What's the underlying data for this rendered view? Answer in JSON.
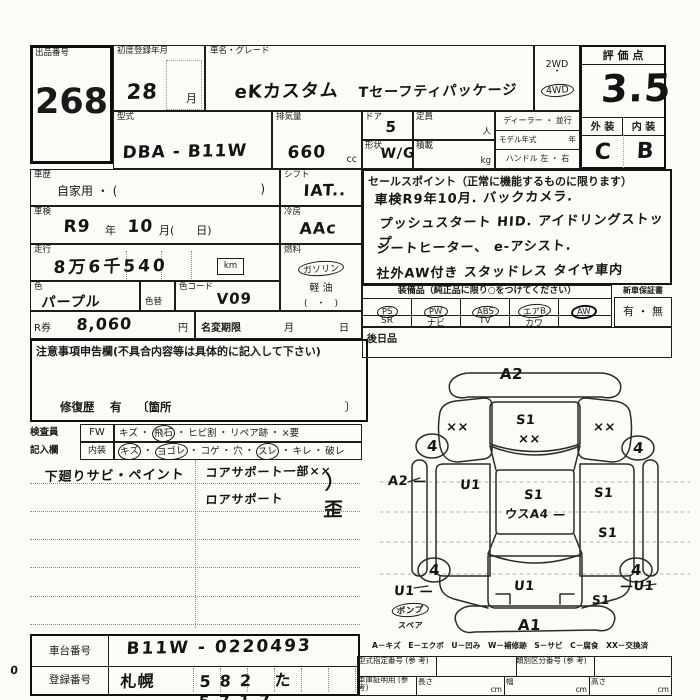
{
  "sheet": {
    "lot": {
      "label": "出品番号",
      "number": "268"
    },
    "first_reg": {
      "label": "初度登録年月",
      "value": "28",
      "unit": "月"
    },
    "car_name": {
      "label": "車名・グレード",
      "name": "eKカスタム",
      "grade": "Tセーフティパッケージ"
    },
    "drive": {
      "opt_2wd": "2WD",
      "dot": "・",
      "opt_4wd": "4WD"
    },
    "score": {
      "label": "評 価 点",
      "value": "3.5",
      "ext_label": "外 装",
      "int_label": "内 装",
      "ext_value": "C",
      "int_value": "B"
    },
    "model": {
      "label": "型式",
      "value": "DBA - B11W"
    },
    "displacement": {
      "label": "排気量",
      "value": "660",
      "unit": "cc"
    },
    "door": {
      "label": "ドア",
      "value": "5"
    },
    "capacity": {
      "label": "定員",
      "unit": "人"
    },
    "shape": {
      "label": "形状",
      "value": "W/G"
    },
    "load": {
      "label": "積載",
      "unit": "kg"
    },
    "dealer": {
      "row1": "ディーラー ・ 並行",
      "row2a": "モデル年式",
      "row2b": "年",
      "row3": "ハンドル 左 ・ 右"
    },
    "history": {
      "label": "車歴",
      "value": "自家用 ・ (",
      "close": ")"
    },
    "shift": {
      "label": "シフト",
      "value": "IAT.."
    },
    "shaken": {
      "label": "車検",
      "era": "R9",
      "year_label": "年",
      "month": "10",
      "rest": "月(　　日)"
    },
    "ac": {
      "label": "冷房",
      "value": "AAc"
    },
    "mileage": {
      "label": "走行",
      "value": "8万6千540",
      "unit": "km"
    },
    "fuel": {
      "label": "燃料",
      "gasoline": "ガソリン",
      "diesel": "軽 油",
      "paren": "(　・　)"
    },
    "color": {
      "label": "色",
      "value": "パープル",
      "change_label": "色替",
      "code_label": "色コード",
      "code_value": "V09"
    },
    "r_ticket": {
      "label": "R券",
      "value": "8,060",
      "unit": "円"
    },
    "name_change": {
      "label": "名変期限",
      "month": "月",
      "day": "日"
    },
    "caution": {
      "label": "注意事項申告欄(不具合内容等は具体的に記入して下さい)",
      "repair_label": "修復歴",
      "repair_value": "有",
      "bracket": "〔箇所",
      "bracket_close": "〕"
    },
    "sales": {
      "label": "セールスポイント（正常に機能するものに限ります）",
      "lines": [
        "車検R9年10月. バックカメラ.",
        "プッシュスタート HID. アイドリングストップ",
        "シートヒーター、 e-アシスト.",
        "社外AW付き スタッドレス タイヤ車内"
      ]
    },
    "equipment": {
      "label": "装備品（純正品に限り○をつけてください）",
      "row1": [
        "PS",
        "PW",
        "ABS",
        "エアB",
        "AW"
      ],
      "row2": [
        "SR",
        "ナビ",
        "TV",
        "カワ",
        ""
      ],
      "warranty_label": "新車保証書",
      "warranty_value": "有 ・ 無",
      "later_label": "後日品"
    },
    "inspector": {
      "col_label1": "検査員",
      "col_label2": "記入欄",
      "fw": "FW",
      "interior": "内装",
      "row1": [
        "キズ",
        "飛石",
        "ヒビ割",
        "リペア跡",
        "×要"
      ],
      "row2": [
        "キズ",
        "ヨゴレ",
        "コゲ",
        "穴",
        "スレ",
        "キレ",
        "破レ"
      ],
      "notes_left": "下廻りサビ・ペイント",
      "notes_right1": "コアサポート一部××",
      "notes_right2": "ロアサポート",
      "notes_right3": "）歪"
    },
    "diagram": {
      "a2_top": "A2",
      "fl_xx": "××",
      "hood_s1": "S1",
      "hood_xx": "××",
      "fr_xx": "××",
      "wheel": "4",
      "a2_left": "A2 —",
      "door_l_u1": "U1",
      "roof_s1": "S1",
      "roof_note": "ウスA4 —",
      "door_r_s1a": "S1",
      "door_r_s1b": "S1",
      "rear_l_u1": "U1 —",
      "rear_c_u1": "U1",
      "rear_r_u1": "—U1",
      "rear_r_s1": "S1",
      "a1": "A1",
      "pump": "ポンプ",
      "spare": "スペア"
    },
    "legend": "A－キズ　E－エクボ　U－凹み　W－補修跡　S－サビ　C－腐食　XX－交換済",
    "footer": {
      "chassis_label": "車台番号",
      "chassis_value": "B11W - 0220493",
      "reg_label": "登録番号",
      "reg_city": "札幌",
      "reg_digits": "582 た 5717",
      "type_desig": "型式指定番号 (参 考)",
      "class_no": "類別区分番号 (参 考)",
      "garage": "車庫証明用 (参 考)",
      "len": "長さ",
      "wid": "幅",
      "hgt": "高さ",
      "cm": "cm",
      "margin_mark": "0"
    }
  }
}
